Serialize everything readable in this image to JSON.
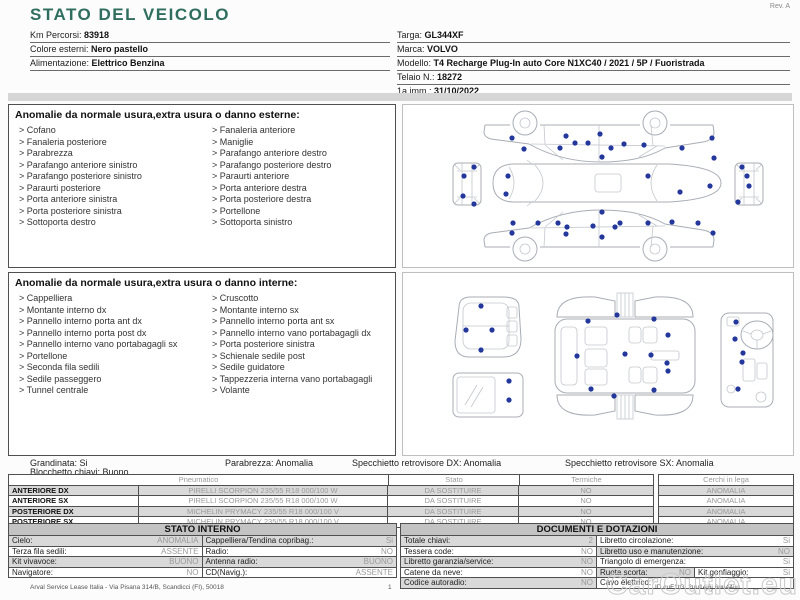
{
  "colors": {
    "accent": "#2f6e5e",
    "damage_dot": "#24389c",
    "row_shade": "#d9d9d9"
  },
  "meta": {
    "rev": "Rev. A",
    "watermark": "CarOutlet.eu"
  },
  "header": {
    "title": "STATO DEL VEICOLO",
    "left_fields": [
      {
        "label": "Km Percorsi:",
        "value": "83918"
      },
      {
        "label": "Colore esterni:",
        "value": "Nero pastello"
      },
      {
        "label": "Alimentazione:",
        "value": "Elettrico Benzina"
      }
    ],
    "right_fields": [
      {
        "label": "Targa:",
        "value": "GL344XF"
      },
      {
        "label": "Marca:",
        "value": "VOLVO"
      },
      {
        "label": "Modello:",
        "value": "T4 Recharge Plug-In auto Core N1XC40 / 2021 / 5P / Fuoristrada"
      },
      {
        "label": "Telaio N.:",
        "value": "18272"
      },
      {
        "label": "1a imm.:",
        "value": "31/10/2022"
      }
    ]
  },
  "exterior": {
    "title": "Anomalie da normale usura,extra usura o danno esterne:",
    "items_left": [
      "Cofano",
      "Fanaleria posteriore",
      "Parabrezza",
      "Parafango anteriore sinistro",
      "Parafango posteriore sinistro",
      "Paraurti posteriore",
      "Porta anteriore sinistra",
      "Porta posteriore sinistra",
      "Sottoporta destro"
    ],
    "items_right": [
      "Fanaleria anteriore",
      "Maniglie",
      "Parafango anteriore destro",
      "Parafango posteriore destro",
      "Paraurti anteriore",
      "Porta anteriore destra",
      "Porta posteriore destra",
      "Portellone",
      "Sottoporta sinistro"
    ],
    "dots": [
      [
        109,
        33
      ],
      [
        121,
        44
      ],
      [
        157,
        43
      ],
      [
        163,
        31
      ],
      [
        172,
        38
      ],
      [
        185,
        38
      ],
      [
        197,
        29
      ],
      [
        199,
        52
      ],
      [
        208,
        43
      ],
      [
        221,
        39
      ],
      [
        241,
        40
      ],
      [
        279,
        43
      ],
      [
        309,
        33
      ],
      [
        311,
        53
      ],
      [
        105,
        71
      ],
      [
        103,
        89
      ],
      [
        245,
        71
      ],
      [
        277,
        87
      ],
      [
        307,
        81
      ],
      [
        71,
        62
      ],
      [
        61,
        71
      ],
      [
        60,
        91
      ],
      [
        71,
        99
      ],
      [
        339,
        62
      ],
      [
        344,
        71
      ],
      [
        346,
        81
      ],
      [
        335,
        97
      ],
      [
        110,
        118
      ],
      [
        109,
        128
      ],
      [
        135,
        118
      ],
      [
        155,
        118
      ],
      [
        164,
        122
      ],
      [
        190,
        121
      ],
      [
        199,
        107
      ],
      [
        212,
        122
      ],
      [
        217,
        118
      ],
      [
        245,
        118
      ],
      [
        269,
        117
      ],
      [
        295,
        118
      ],
      [
        310,
        128
      ],
      [
        163,
        129
      ],
      [
        199,
        132
      ]
    ]
  },
  "interior": {
    "title": "Anomalie da normale usura,extra usura o danno interne:",
    "items_left": [
      "Cappelliera",
      "Montante interno dx",
      "Pannello interno porta ant dx",
      "Pannello interno porta post dx",
      "Pannello interno vano portabagagli sx",
      "Portellone",
      "Seconda fila sedili",
      "Sedile passeggero",
      "Tunnel centrale"
    ],
    "items_right": [
      "Cruscotto",
      "Montante interno sx",
      "Pannello interno porta ant sx",
      "Pannello interno vano portabagagli dx",
      "Porta posteriore sinistra",
      "Schienale sedile post",
      "Sedile guidatore",
      "Tappezzeria interna vano portabagagli",
      "Volante"
    ],
    "dots": [
      [
        78,
        33
      ],
      [
        63,
        57
      ],
      [
        89,
        57
      ],
      [
        78,
        77
      ],
      [
        106,
        108
      ],
      [
        106,
        127
      ],
      [
        185,
        48
      ],
      [
        214,
        42
      ],
      [
        251,
        46
      ],
      [
        265,
        62
      ],
      [
        174,
        83
      ],
      [
        222,
        81
      ],
      [
        248,
        82
      ],
      [
        264,
        90
      ],
      [
        265,
        98
      ],
      [
        188,
        116
      ],
      [
        211,
        123
      ],
      [
        251,
        117
      ],
      [
        333,
        49
      ],
      [
        332,
        66
      ],
      [
        340,
        80
      ],
      [
        339,
        89
      ],
      [
        335,
        116
      ]
    ]
  },
  "status_row": {
    "line1": [
      {
        "label": "Grandinata:",
        "value": "Si",
        "left": 30
      },
      {
        "label": "Parabrezza:",
        "value": "Anomalia",
        "left": 225
      },
      {
        "label": "Specchietto retrovisore DX:",
        "value": "Anomalia",
        "left": 352
      },
      {
        "label": "Specchietto retrovisore SX:",
        "value": "Anomalia",
        "left": 565
      }
    ],
    "line2": {
      "label": "Blocchetto chiavi:",
      "value": "Buono",
      "left": 30
    }
  },
  "tires": {
    "headers": [
      "Pneumatico",
      "Stato",
      "Termiche"
    ],
    "wheels_header": "Cerchi in lega",
    "rows": [
      {
        "position": "ANTERIORE DX",
        "tire": "PIRELLI SCORPION  235/55 R18 000/100 W",
        "stato": "DA SOSTITUIRE",
        "termiche": "NO",
        "cerchi": "ANOMALIA"
      },
      {
        "position": "ANTERIORE SX",
        "tire": "PIRELLI SCORPION  235/55 R18 000/100 W",
        "stato": "DA SOSTITUIRE",
        "termiche": "NO",
        "cerchi": "ANOMALIA"
      },
      {
        "position": "POSTERIORE DX",
        "tire": "MICHELIN PRYMACY  235/55 R18 000/100 V",
        "stato": "DA SOSTITUIRE",
        "termiche": "NO",
        "cerchi": "ANOMALIA"
      },
      {
        "position": "POSTERIORE SX",
        "tire": "MICHELIN PRYMACY  235/55 R18 000/100 V",
        "stato": "DA SOSTITUIRE",
        "termiche": "NO",
        "cerchi": "ANOMALIA"
      }
    ]
  },
  "stato_interno": {
    "title": "STATO INTERNO",
    "rows": [
      [
        {
          "label": "Cielo:",
          "value": "ANOMALIA"
        },
        {
          "label": "Cappelliera/Tendina copribag.:",
          "value": "Si"
        }
      ],
      [
        {
          "label": "Terza fila sedili:",
          "value": "ASSENTE"
        },
        {
          "label": "Radio:",
          "value": "NO"
        }
      ],
      [
        {
          "label": "Kit vivavoce:",
          "value": "BUONO"
        },
        {
          "label": "Antenna radio:",
          "value": "BUONO"
        }
      ],
      [
        {
          "label": "Navigatore:",
          "value": "NO"
        },
        {
          "label": "CD(Navig.):",
          "value": "ASSENTE"
        }
      ]
    ]
  },
  "documenti": {
    "title": "DOCUMENTI E DOTAZIONI",
    "rows": [
      [
        {
          "label": "Totale chiavi:",
          "value": "2"
        },
        {
          "label": "Libretto circolazione:",
          "value": "Si"
        }
      ],
      [
        {
          "label": "Tessera code:",
          "value": "NO"
        },
        {
          "label": "Libretto uso e manutenzione:",
          "value": "NO"
        }
      ],
      [
        {
          "label": "Libretto garanzia/service:",
          "value": "NO"
        },
        {
          "label": "Triangolo di emergenza:",
          "value": "Si"
        }
      ],
      [
        {
          "label": "Catene da neve:",
          "value": "NO"
        },
        {
          "label": "Ruota scorta:",
          "value": "NO"
        },
        {
          "label": "Kit gonfiaggio:",
          "value": "Si"
        }
      ],
      [
        {
          "label": "Codice autoradio:",
          "value": "NO"
        },
        {
          "label": "Cavo elettrico:",
          "value": ""
        }
      ]
    ]
  },
  "footer": {
    "left": "Arval Service Lease Italia - Via Pisana 314/B, Scandicci (FI), 50018",
    "page": "1",
    "right": "ID cuF1tG. 2uu14j6j 6uu44uu"
  }
}
